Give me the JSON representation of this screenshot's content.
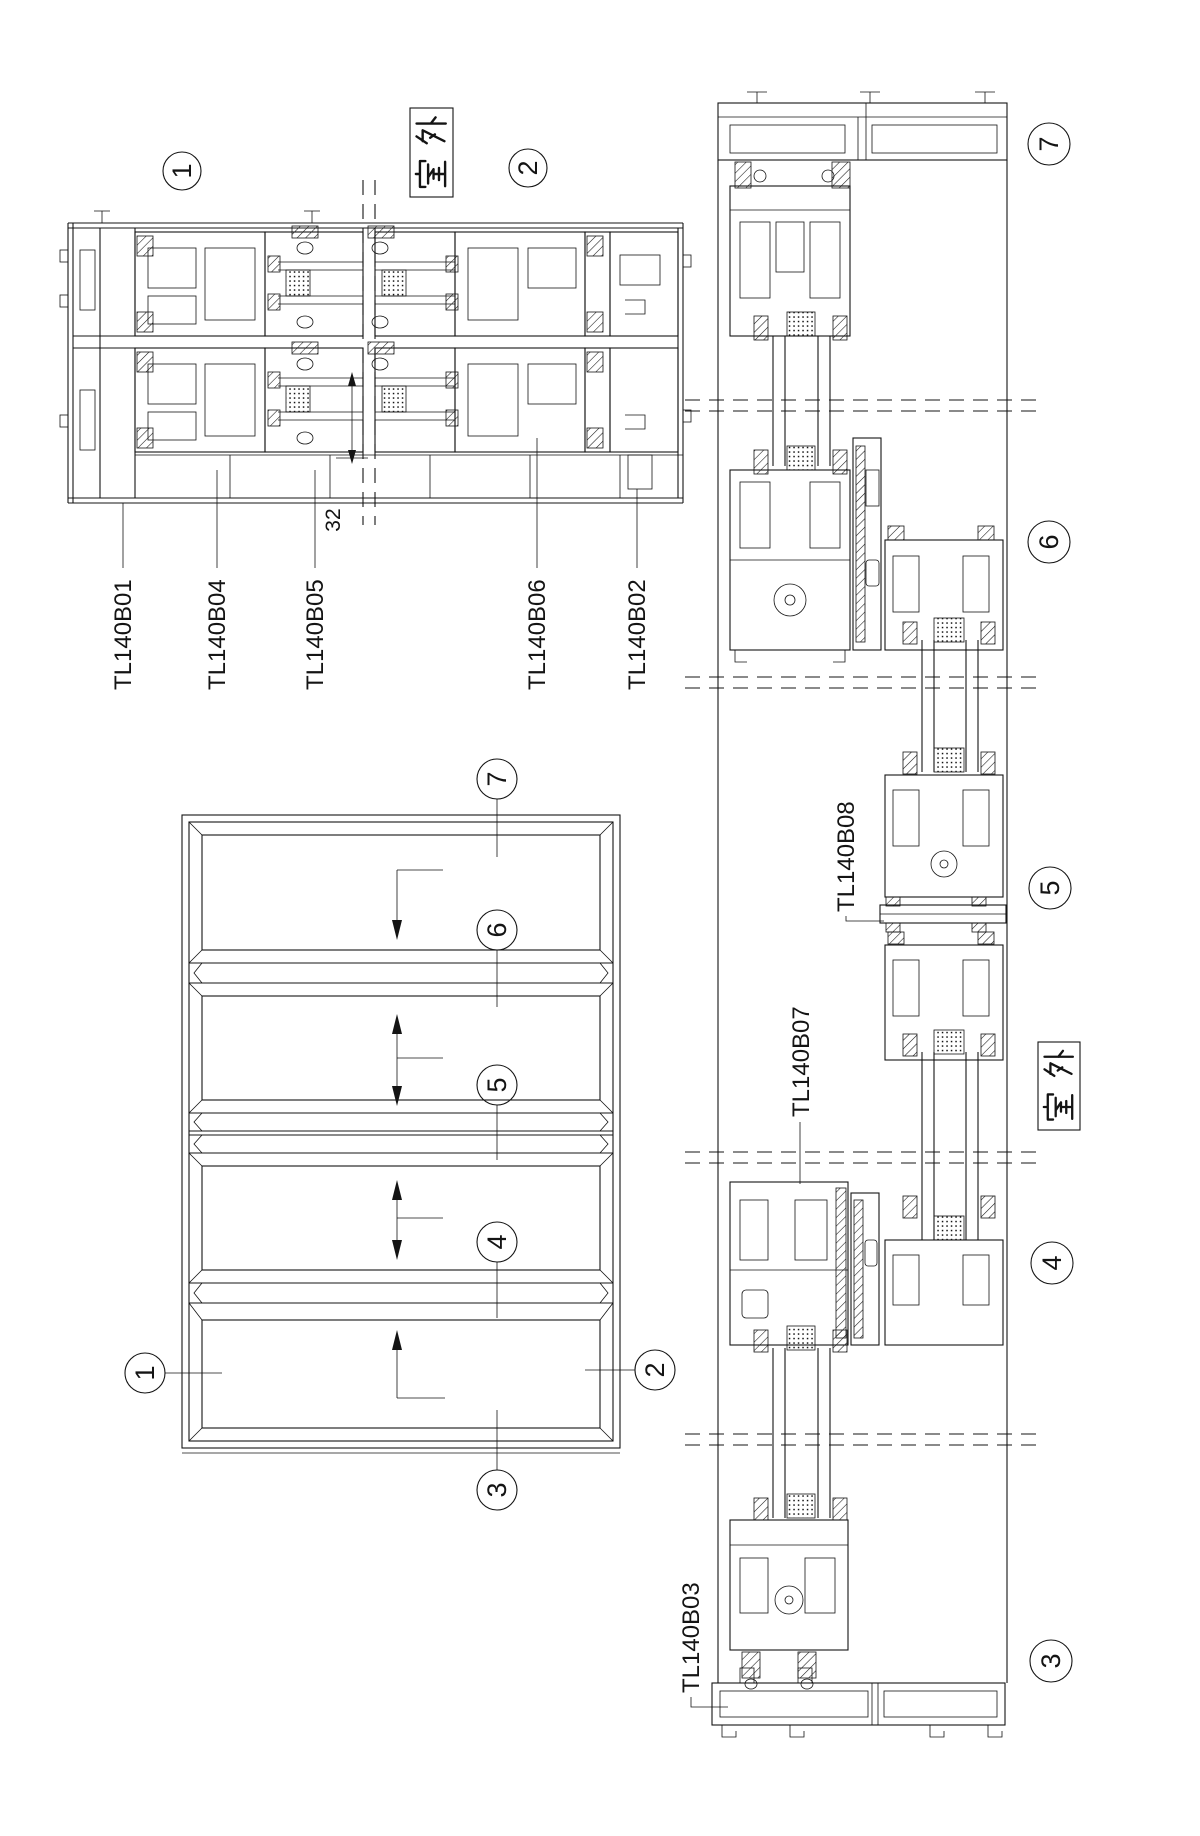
{
  "plan_section": {
    "markers": [
      "1",
      "2"
    ],
    "outdoor_label": "室外",
    "dimension_label": "32",
    "labels": [
      "TL140B01",
      "TL140B04",
      "TL140B05",
      "TL140B06",
      "TL140B02"
    ]
  },
  "elevation": {
    "markers": [
      "1",
      "2",
      "3",
      "4",
      "5",
      "6",
      "7"
    ]
  },
  "vertical_section": {
    "markers": [
      "7",
      "6",
      "5",
      "4",
      "3"
    ],
    "outdoor_label": "室外",
    "labels": [
      "TL140B08",
      "TL140B07",
      "TL140B03"
    ]
  }
}
